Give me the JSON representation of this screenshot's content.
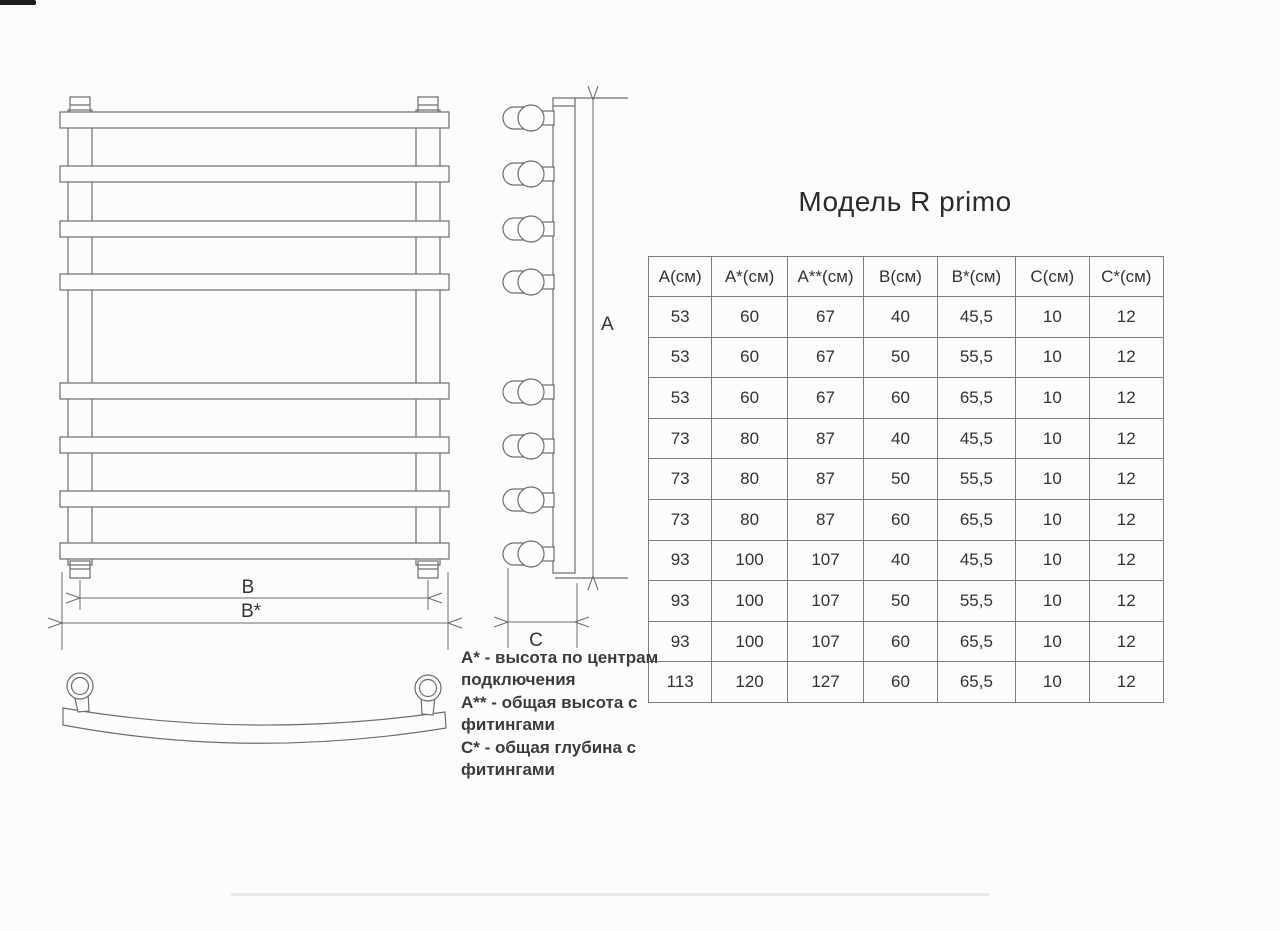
{
  "title": "Модель R primo",
  "table": {
    "headers": [
      "А(см)",
      "А*(см)",
      "А**(см)",
      "В(см)",
      "В*(см)",
      "С(см)",
      "С*(см)"
    ],
    "rows": [
      [
        "53",
        "60",
        "67",
        "40",
        "45,5",
        "10",
        "12"
      ],
      [
        "53",
        "60",
        "67",
        "50",
        "55,5",
        "10",
        "12"
      ],
      [
        "53",
        "60",
        "67",
        "60",
        "65,5",
        "10",
        "12"
      ],
      [
        "73",
        "80",
        "87",
        "40",
        "45,5",
        "10",
        "12"
      ],
      [
        "73",
        "80",
        "87",
        "50",
        "55,5",
        "10",
        "12"
      ],
      [
        "73",
        "80",
        "87",
        "60",
        "65,5",
        "10",
        "12"
      ],
      [
        "93",
        "100",
        "107",
        "40",
        "45,5",
        "10",
        "12"
      ],
      [
        "93",
        "100",
        "107",
        "50",
        "55,5",
        "10",
        "12"
      ],
      [
        "93",
        "100",
        "107",
        "60",
        "65,5",
        "10",
        "12"
      ],
      [
        "113",
        "120",
        "127",
        "60",
        "65,5",
        "10",
        "12"
      ]
    ]
  },
  "legend": {
    "lines": [
      "А* - высота по центрам",
      "подключения",
      "А** - общая высота с",
      "фитингами",
      "С* - общая глубина с",
      "фитингами"
    ]
  },
  "drawing": {
    "labels": {
      "height": "A",
      "width_centers": "B",
      "width_overall": "B*",
      "depth": "C"
    },
    "bar_count": 8
  },
  "colors": {
    "line": "#6e6e6e",
    "text": "#333333",
    "background": "#fcfcfb",
    "table_border": "#7d7d7d"
  }
}
